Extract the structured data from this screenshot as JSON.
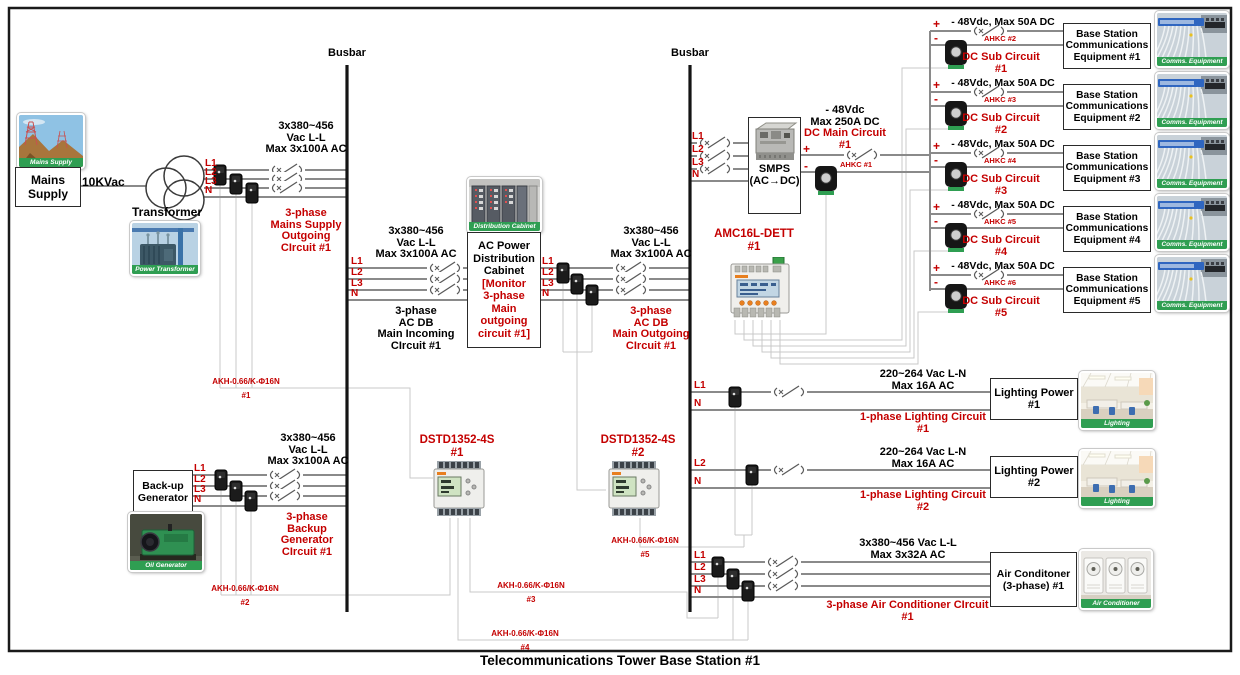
{
  "title": "Telecommunications Tower Base Station #1",
  "colors": {
    "accent_red": "#c40000",
    "caption_green": "#2f9e52",
    "line_gray": "#8a8a8a",
    "sense_wire_gray": "#c6c6c6"
  },
  "busbars": {
    "left": "Busbar",
    "right": "Busbar"
  },
  "mains": {
    "photo_caption": "Mains Supply",
    "box": "Mains\nSupply",
    "voltage": "10KVac",
    "transformer_label": "Transformer",
    "transformer_photo_caption": "Power Transformer",
    "phases": [
      "L1",
      "L2",
      "L3",
      "N"
    ],
    "rating": "3x380~456\nVac L-L\nMax 3x100A AC",
    "circuit": "3-phase\nMains Supply\nOutgoing\nCIrcuit #1",
    "ct_label": "AKH-0.66/K-Φ16N\n#1"
  },
  "incoming": {
    "phases": [
      "L1",
      "L2",
      "L3",
      "N"
    ],
    "rating": "3x380~456\nVac L-L\nMax 3x100A AC",
    "circuit": "3-phase\nAC DB\nMain Incoming\nCIrcuit #1"
  },
  "cabinet": {
    "photo_caption": "Distribution Cabinet",
    "box_black": "AC Power\nDistribution\nCabinet",
    "box_red": "[Monitor\n3-phase\nMain\noutgoing\ncircuit #1]"
  },
  "outgoing": {
    "phases": [
      "L1",
      "L2",
      "L3",
      "N"
    ],
    "rating": "3x380~456\nVac L-L\nMax 3x100A AC",
    "circuit": "3-phase\nAC DB\nMain Outgoing\nCIrcuit #1"
  },
  "generator": {
    "box": "Back-up\nGenerator",
    "photo_caption": "Oil Generator",
    "phases": [
      "L1",
      "L2",
      "L3",
      "N"
    ],
    "rating": "3x380~456\nVac L-L\nMax 3x100A AC",
    "circuit": "3-phase\nBackup\nGenerator\nCIrcuit #1",
    "ct_label": "AKH-0.66/K-Φ16N\n#2"
  },
  "meters": {
    "dstd1": "DSTD1352-4S\n#1",
    "dstd2": "DSTD1352-4S\n#2",
    "amc": "AMC16L-DETT\n#1",
    "ct3": "AKH-0.66/K-Φ16N\n#3",
    "ct4": "AKH-0.66/K-Φ16N\n#4",
    "ct5": "AKH-0.66/K-Φ16N\n#5"
  },
  "smps": {
    "phases": [
      "L1",
      "L2",
      "L3",
      "N"
    ],
    "box": "SMPS\n(AC→DC)",
    "plus": "+",
    "minus": "-",
    "rating": "- 48Vdc\nMax 250A DC",
    "circuit": "DC Main Circuit\n#1",
    "sensor": "AHKC #1"
  },
  "dc_sub_circuits": [
    {
      "plus": "+",
      "minus": "-",
      "rating": "- 48Vdc, Max 50A DC",
      "sensor": "AHKC #2",
      "circuit": "DC Sub Circuit\n#1",
      "equipment": "Base Station\nCommunications\nEquipment #1",
      "photo_caption": "Comms. Equipment"
    },
    {
      "plus": "+",
      "minus": "-",
      "rating": "- 48Vdc, Max 50A DC",
      "sensor": "AHKC #3",
      "circuit": "DC Sub Circuit\n#2",
      "equipment": "Base Station\nCommunications\nEquipment #2",
      "photo_caption": "Comms. Equipment"
    },
    {
      "plus": "+",
      "minus": "-",
      "rating": "- 48Vdc, Max 50A DC",
      "sensor": "AHKC #4",
      "circuit": "DC Sub Circuit\n#3",
      "equipment": "Base Station\nCommunications\nEquipment #3",
      "photo_caption": "Comms. Equipment"
    },
    {
      "plus": "+",
      "minus": "-",
      "rating": "- 48Vdc, Max 50A DC",
      "sensor": "AHKC #5",
      "circuit": "DC Sub Circuit\n#4",
      "equipment": "Base Station\nCommunications\nEquipment #4",
      "photo_caption": "Comms. Equipment"
    },
    {
      "plus": "+",
      "minus": "-",
      "rating": "- 48Vdc, Max 50A DC",
      "sensor": "AHKC #6",
      "circuit": "DC Sub Circuit\n#5",
      "equipment": "Base Station\nCommunications\nEquipment #5",
      "photo_caption": "Comms. Equipment"
    }
  ],
  "lighting_circuits": [
    {
      "phase": "L1",
      "neutral": "N",
      "rating": "220~264 Vac L-N\nMax 16A AC",
      "circuit": "1-phase Lighting Circuit\n#1",
      "box": "Lighting\nPower\n#1",
      "photo_caption": "Lighting"
    },
    {
      "phase": "L2",
      "neutral": "N",
      "rating": "220~264 Vac L-N\nMax 16A AC",
      "circuit": "1-phase Lighting Circuit\n#2",
      "box": "Lighting\nPower\n#2",
      "photo_caption": "Lighting"
    }
  ],
  "air_conditioner": {
    "phases": [
      "L1",
      "L2",
      "L3",
      "N"
    ],
    "rating": "3x380~456 Vac L-L\nMax 3x32A AC",
    "circuit": "3-phase Air Conditioner CIrcuit\n#1",
    "box": "Air Conditoner\n(3-phase)\n#1",
    "photo_caption": "Air Conditioner"
  }
}
